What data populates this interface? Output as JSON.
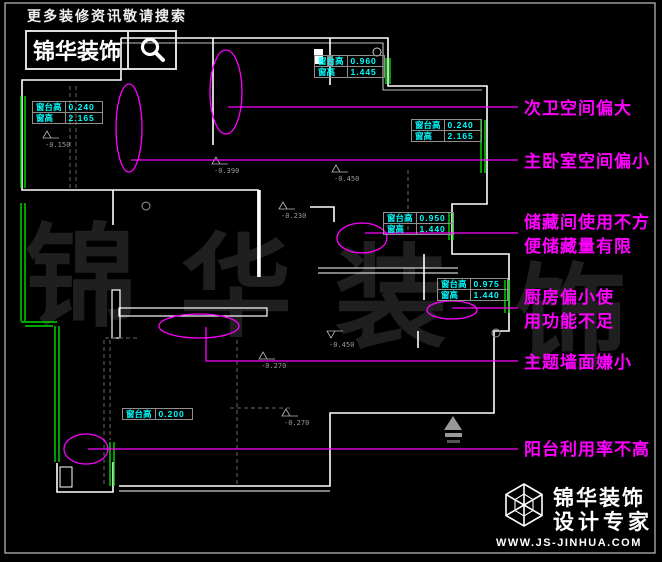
{
  "header": {
    "slogan": "更多装修资讯敬请搜索",
    "brand": "锦华装饰"
  },
  "watermark": {
    "chars": [
      "锦",
      "华",
      "装",
      "饰"
    ]
  },
  "annotations": [
    {
      "lines": [
        "次卫空间偏大"
      ]
    },
    {
      "lines": [
        "主卧室空间偏小"
      ]
    },
    {
      "lines": [
        "储藏间使用不方",
        "便储藏量有限"
      ]
    },
    {
      "lines": [
        "厨房偏小使",
        "用功能不足"
      ]
    },
    {
      "lines": [
        "主题墙面嫌小"
      ]
    },
    {
      "lines": [
        "阳台利用率不高"
      ]
    }
  ],
  "dim_tables": [
    {
      "rows": [
        [
          "窗台高",
          "0.240"
        ],
        [
          "窗高",
          "2.165"
        ]
      ]
    },
    {
      "rows": [
        [
          "窗台高",
          "0.960"
        ],
        [
          "窗高",
          "1.445"
        ]
      ]
    },
    {
      "rows": [
        [
          "窗台高",
          "0.240"
        ],
        [
          "窗高",
          "2.165"
        ]
      ]
    },
    {
      "rows": [
        [
          "窗台高",
          "0.950"
        ],
        [
          "窗高",
          "1.440"
        ]
      ]
    },
    {
      "rows": [
        [
          "窗台高",
          "0.975"
        ],
        [
          "窗高",
          "1.440"
        ]
      ]
    },
    {
      "rows": [
        [
          "窗台高",
          "0.200"
        ]
      ]
    }
  ],
  "level_markers": [
    {
      "value": "-0.150"
    },
    {
      "value": "-0.390"
    },
    {
      "value": "-0.450"
    },
    {
      "value": "-0.230"
    },
    {
      "value": "-0.270"
    },
    {
      "value": "-0.270"
    },
    {
      "value": "-0.450"
    }
  ],
  "footer": {
    "brand": "锦华装饰",
    "tagline": "设计专家",
    "website": "WWW.JS-JINHUA.COM"
  },
  "colors": {
    "background": "#000000",
    "wall": "#ffffff",
    "window": "#00dd00",
    "dimension_text": "#00ffff",
    "annotation": "#ff00ff",
    "watermark": "#1f1f1f"
  }
}
